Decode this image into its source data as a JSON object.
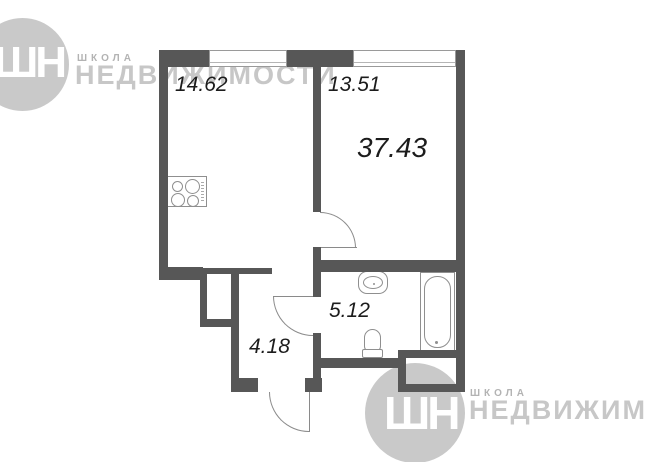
{
  "watermark_top": {
    "monogram": "ШН",
    "school_label": "ШКОЛА",
    "brand_label": "НЕДВИЖИМОСТИ"
  },
  "watermark_bottom": {
    "monogram": "ШН",
    "school_label": "ШКОЛА",
    "brand_label": "НЕДВИЖИМОСТ"
  },
  "floor_plan": {
    "type": "apartment-floor-plan",
    "total_area_label": "37.43",
    "rooms": [
      {
        "name": "kitchen-living-room",
        "area_label": "14.62"
      },
      {
        "name": "room",
        "area_label": "13.51"
      },
      {
        "name": "bathroom",
        "area_label": "5.12"
      },
      {
        "name": "hallway",
        "area_label": "4.18"
      }
    ],
    "fixtures": [
      "stove",
      "sink",
      "toilet",
      "bathtub"
    ]
  },
  "colors": {
    "wall": "#575757",
    "watermark": "#c9c9c9",
    "fixture_line": "#8f8f8f",
    "label_text": "#1c1c1c"
  }
}
